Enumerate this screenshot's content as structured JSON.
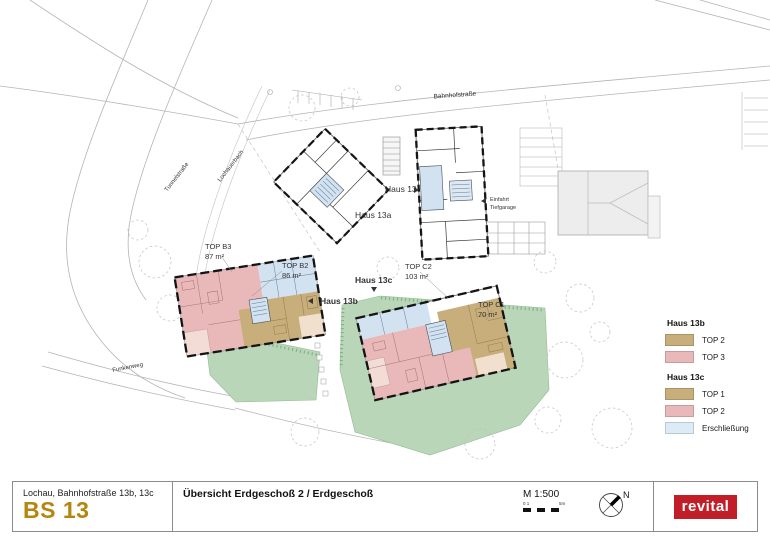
{
  "plan": {
    "streets": {
      "bahnhofstrasse": "Bahnhofstraße",
      "tunnelstrasse": "Tunnelstraße",
      "lochauerbach": "Lochauerbach",
      "funkenweg": "Funkenweg"
    },
    "buildings": {
      "haus13": "Haus 13",
      "haus13a": "Haus 13a",
      "haus13b": "Haus 13b",
      "haus13c": "Haus 13c"
    },
    "annotations": {
      "einfahrt_line1": "Einfahrt",
      "einfahrt_line2": "Tiefgarage"
    },
    "units": [
      {
        "label": "TOP B3",
        "area": "87 m²"
      },
      {
        "label": "TOP B2",
        "area": "86 m²"
      },
      {
        "label": "TOP C2",
        "area": "103 m²"
      },
      {
        "label": "TOP C1",
        "area": "70 m²"
      }
    ],
    "colors": {
      "unit_tan": "#c8ae7a",
      "unit_pink": "#e9b9ba",
      "terrace_pink": "#f3dcd6",
      "terrace_tan": "#f2e0ce",
      "circulation_blue": "#d2e2f0",
      "lawn_green": "#b9d6b9",
      "neighbor_gray": "#ededed"
    }
  },
  "legend": {
    "groups": [
      {
        "title": "Haus 13b",
        "items": [
          {
            "label": "TOP 2",
            "color": "#c8ae7a"
          },
          {
            "label": "TOP 3",
            "color": "#e9b9ba"
          }
        ]
      },
      {
        "title": "Haus 13c",
        "items": [
          {
            "label": "TOP 1",
            "color": "#c8ae7a"
          },
          {
            "label": "TOP 2",
            "color": "#e9b9ba"
          },
          {
            "label": "Erschließung",
            "color": "#dcebf6"
          }
        ]
      }
    ]
  },
  "title_block": {
    "address": "Lochau, Bahnhofstraße 13b, 13c",
    "code": "BS 13",
    "code_color": "#b5860d",
    "sheet_title": "Übersicht Erdgeschoß 2 / Erdgeschoß",
    "scale": "M 1:500",
    "scale_start": "0 1",
    "scale_end": "5m",
    "north": "N",
    "logo": "revital",
    "logo_color": "#c21e28"
  }
}
